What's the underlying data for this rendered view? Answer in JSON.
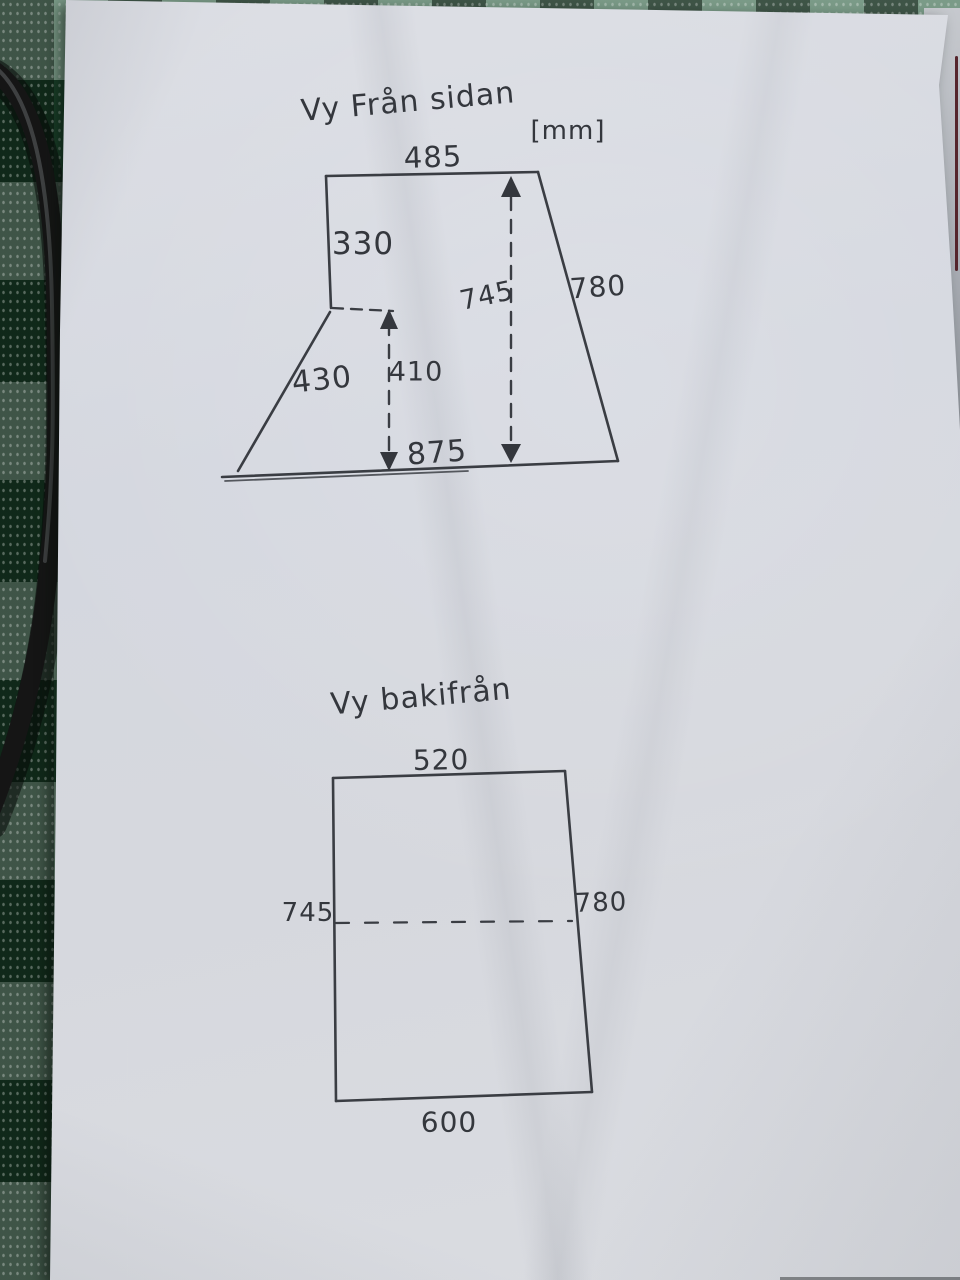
{
  "unit_label": "[mm]",
  "side_view": {
    "title": "Vy Från sidan",
    "dims": {
      "top_width": "485",
      "left_upper_side": "330",
      "height_overall": "745",
      "right_side": "780",
      "left_lower_slant": "430",
      "lower_height": "410",
      "bottom_width": "875"
    }
  },
  "back_view": {
    "title": "Vy bakifrån",
    "dims": {
      "top_width": "520",
      "left_side": "745",
      "right_side": "780",
      "bottom_width": "600"
    }
  },
  "colors": {
    "paper": "#d7d9e0",
    "ink": "#34373d",
    "tablecloth_green": "#205235",
    "tablecloth_dark": "#132a1b",
    "tablecloth_light": "#aec7b5",
    "cable": "#151515"
  }
}
